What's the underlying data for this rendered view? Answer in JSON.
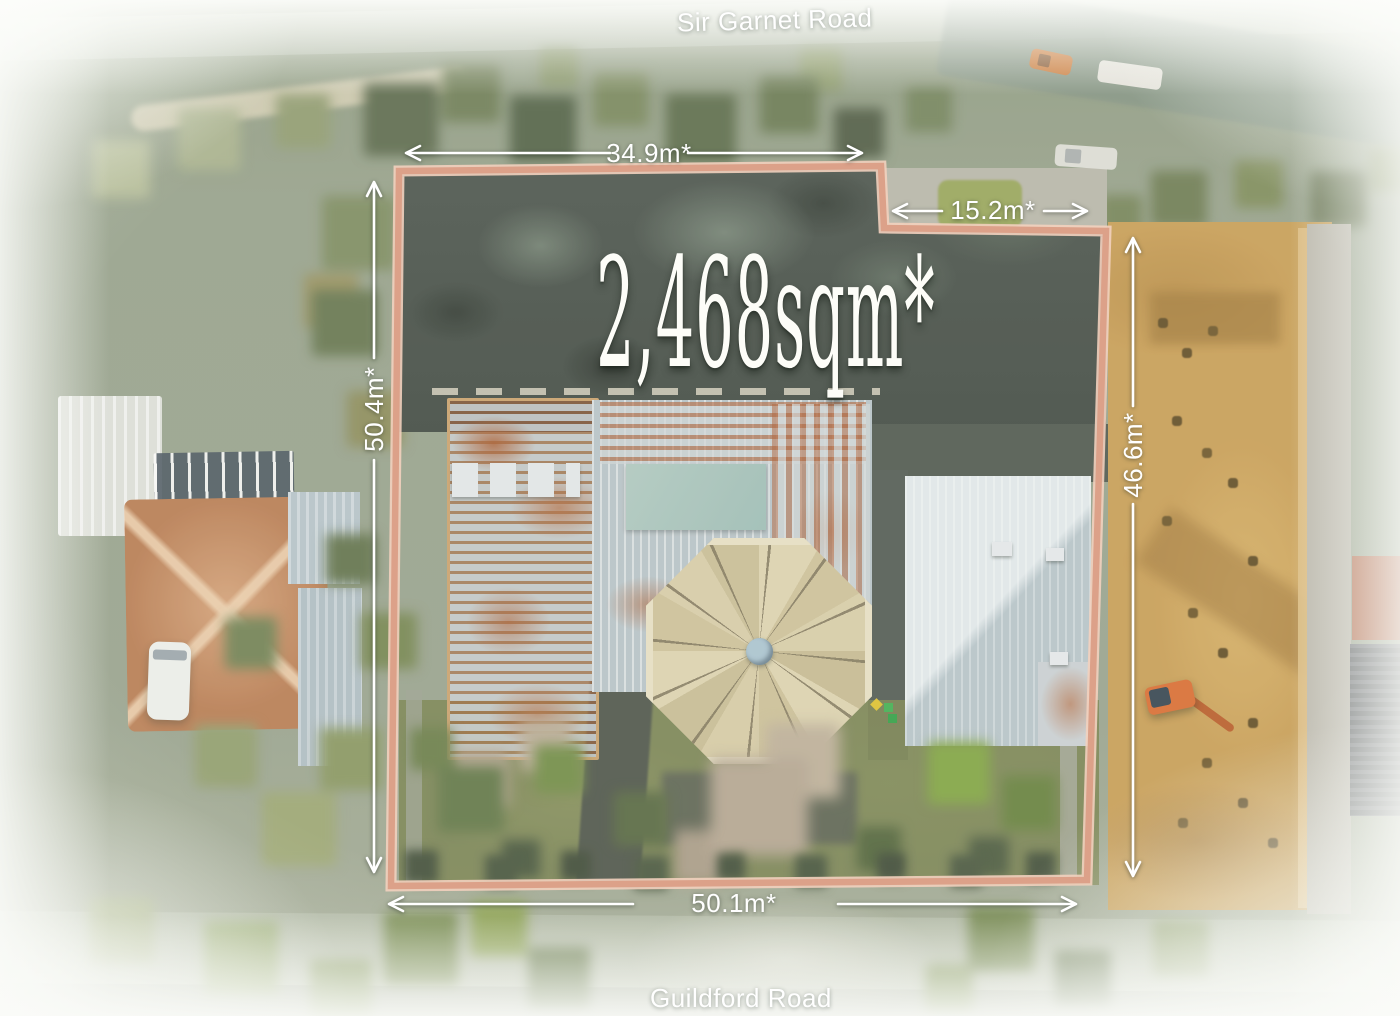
{
  "labels": {
    "road_top": "Sir Garnet Road",
    "road_bottom": "Guildford Road",
    "area": "2,468sqm*",
    "dim_top_width": "34.9m*",
    "dim_notch_width": "15.2m*",
    "dim_left_depth": "50.4m*",
    "dim_right_depth": "46.6m*",
    "dim_bottom_width": "50.1m*"
  },
  "colors": {
    "boundary_line": "#dca189",
    "boundary_line_light": "#f2d0be",
    "annotation_text": "#ffffff",
    "excavation_dirt": "#c79c52",
    "octagon_roof": "#d5caa3",
    "rust_roof": "#ab5a2c"
  }
}
